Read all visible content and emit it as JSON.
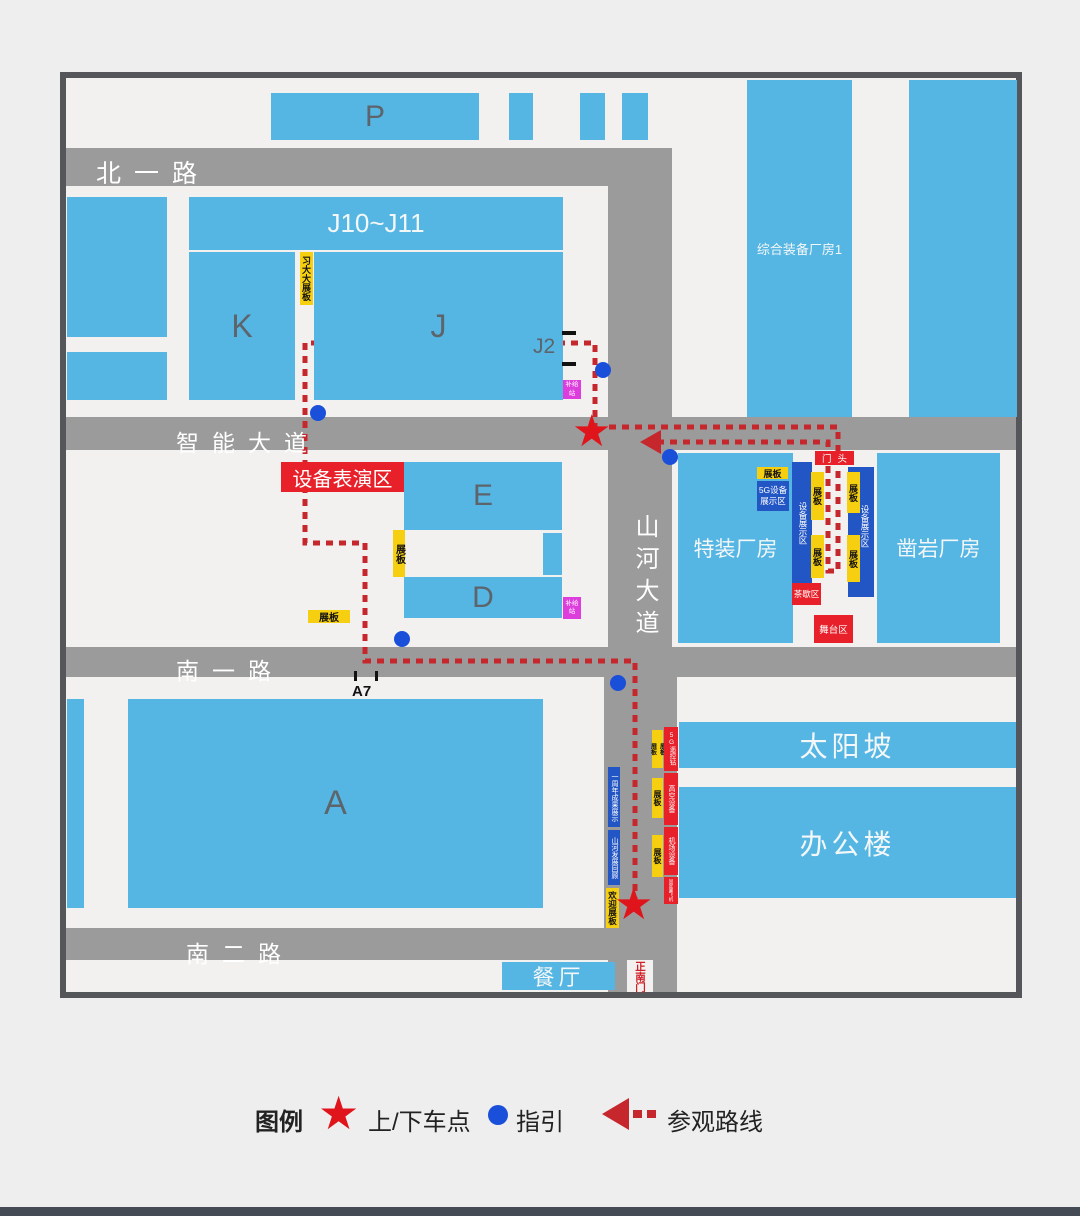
{
  "colors": {
    "building_blue": "#55b6e3",
    "road_gray": "#9b9b9b",
    "accent_red": "#e8202a",
    "route_red": "#c5272d",
    "panel_yellow": "#f7cf11",
    "deep_blue": "#2356c5",
    "magenta": "#dd3ddd",
    "dot_blue": "#1a4fd9",
    "frame_gray": "#54565a"
  },
  "icons": {
    "star": "★"
  },
  "roads": {
    "north1": "北一路",
    "main_ew": "智能大道",
    "main_ns": "山河大道",
    "south1": "南一路",
    "south2": "南二路"
  },
  "buildings": {
    "p": "P",
    "j10_j11": "J10~J11",
    "k": "K",
    "j": "J",
    "j2": "J2",
    "e": "E",
    "d": "D",
    "a": "A",
    "comprehensive_plant": "综合装备厂房1",
    "special_plant": "特装厂房",
    "rock_drill_plant": "凿岩厂房",
    "sun_slope": "太阳坡",
    "office": "办公楼",
    "canteen": "餐厅"
  },
  "markers": {
    "a7": "A7",
    "gate_head": "门头",
    "south_gate": "正南门"
  },
  "areas": {
    "equipment_show": "设备表演区",
    "g5_display_zone": "5G设备展示区",
    "equipment_display_zone": "设备展示区",
    "tea_break": "茶歇区",
    "stage": "舞台区",
    "supply_station": "补给站",
    "xi_board": "习大大展板",
    "display_board": "展板",
    "welcome_board": "欢迎展板",
    "anniversary": "一周年成果展示",
    "development": "山河发展回顾",
    "g5_drill": "5G遥控钻",
    "aerial_equipment": "高空设备",
    "airport_equipment": "机场设备",
    "fixed_wing": "固定翼飞机"
  },
  "legend": {
    "title": "图例",
    "pickup": "上/下车点",
    "guide": "指引",
    "route": "参观路线"
  }
}
